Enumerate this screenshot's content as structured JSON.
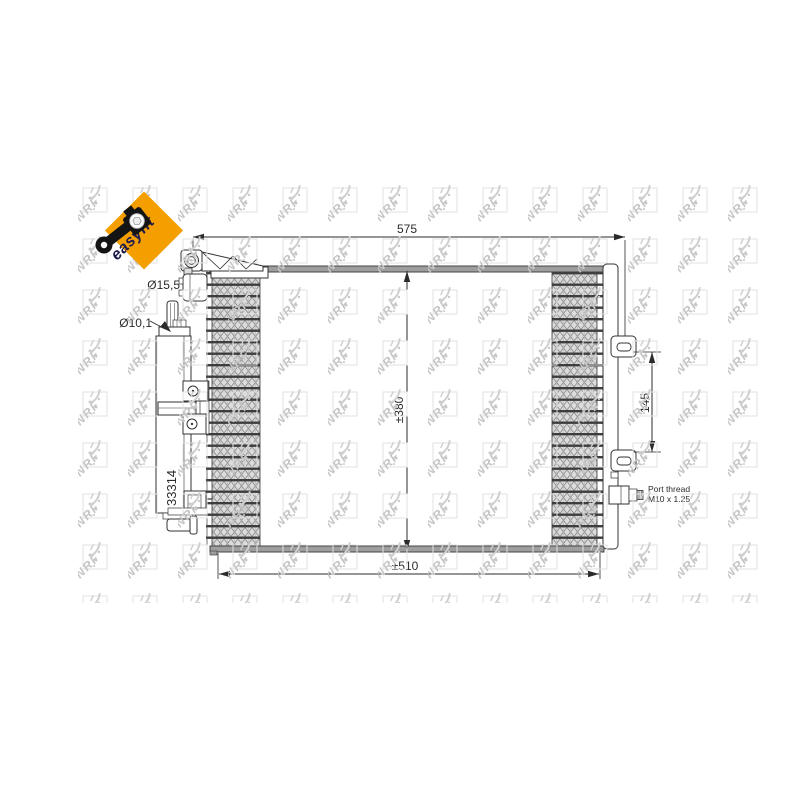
{
  "watermark": {
    "brand": "NRF"
  },
  "badge": {
    "label": "easyfit",
    "bg_color": "#F59E00",
    "text_color": "#1B1B4E"
  },
  "part": {
    "number": "33314"
  },
  "dims": {
    "top_width": "575",
    "core_height": "±380",
    "core_width": "±510",
    "bracket_gap": "145",
    "inlet_port": "Ø15,5",
    "receiver_inlet": "Ø10,1"
  },
  "port": {
    "line1": "Port thread",
    "line2": "M10 x 1.25"
  },
  "colors": {
    "line": "#2B2B2B",
    "plate": "#9E9E9E",
    "fin_dark": "#3D3D3D"
  }
}
